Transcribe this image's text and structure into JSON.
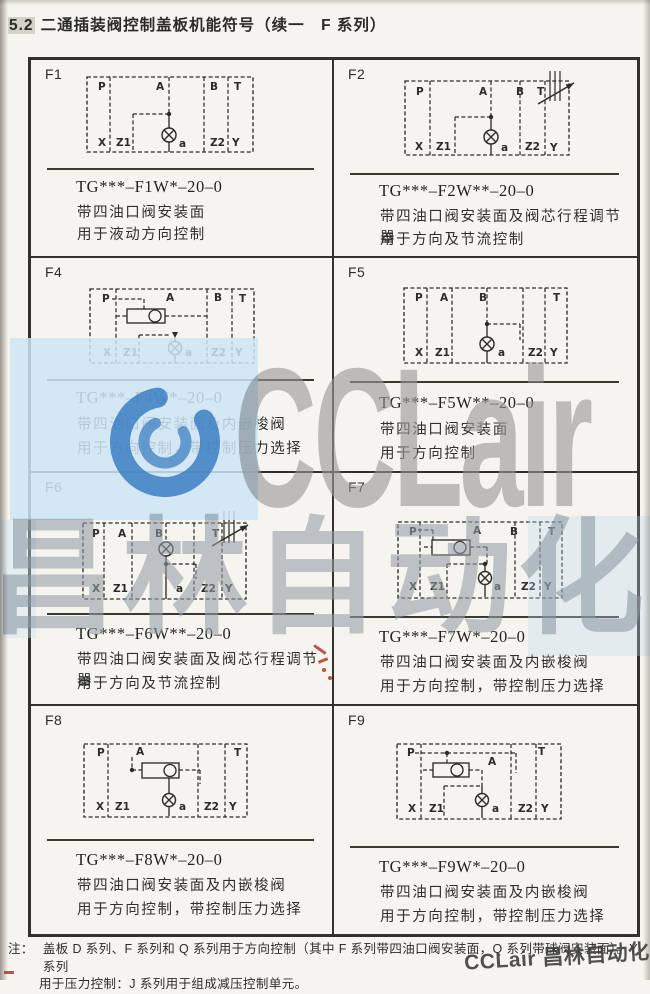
{
  "header": {
    "num": "5.2",
    "title": "二通插装阀控制盖板机能符号（续一　F 系列）"
  },
  "watermark": {
    "brand": "CCLair",
    "brand_cn": "昌林自动化",
    "corner": "CCLair 昌林自动化",
    "accent_blue": "#3e86c8",
    "band_blue": "#cde4f5",
    "gray": "#989895"
  },
  "footnote": {
    "label": "注：",
    "line1": "盖板 D 系列、F 系列和 Q 系列用于方向控制（其中 F 系列带四油口阀安装面，Q 系列带球阀安装面）。Y 系列",
    "line2": "用于压力控制：J 系列用于组成减压控制单元。"
  },
  "cells": [
    {
      "code": "F1",
      "model": "TG***–F1W*–20–0",
      "desc1": "带四油口阀安装面",
      "desc2": "用于液动方向控制",
      "diagram": {
        "vb": [
          170,
          78
        ],
        "rect": [
          1,
          1,
          166,
          75
        ],
        "dividers": [
          24,
          118,
          142
        ],
        "labels": [
          {
            "t": "P",
            "x": 12,
            "y": 14
          },
          {
            "t": "A",
            "x": 70,
            "y": 14
          },
          {
            "t": "B",
            "x": 124,
            "y": 14
          },
          {
            "t": "T",
            "x": 148,
            "y": 14
          },
          {
            "t": "X",
            "x": 12,
            "y": 70
          },
          {
            "t": "Z1",
            "x": 30,
            "y": 70
          },
          {
            "t": "a",
            "x": 93,
            "y": 71
          },
          {
            "t": "Z2",
            "x": 124,
            "y": 70
          },
          {
            "t": "Y",
            "x": 146,
            "y": 70
          }
        ],
        "dashed": [
          [
            83,
            1,
            83,
            38
          ],
          [
            47,
            38,
            83,
            38
          ],
          [
            47,
            38,
            47,
            76
          ]
        ],
        "solid": [
          [
            83,
            38,
            83,
            52
          ],
          [
            83,
            66,
            83,
            76
          ]
        ],
        "dots": [
          [
            83,
            38
          ]
        ],
        "valve": {
          "x": 83,
          "y": 59,
          "r": 7
        }
      }
    },
    {
      "code": "F2",
      "model": "TG***–F2W**–20–0",
      "desc1": "带四油口阀安装面及阀芯行程调节器",
      "desc2": "用于方向及节流控制",
      "diagram": {
        "vb": [
          178,
          88
        ],
        "rect": [
          1,
          10,
          164,
          74
        ],
        "dividers": [
          26,
          116,
          141
        ],
        "labels": [
          {
            "t": "P",
            "x": 12,
            "y": 24
          },
          {
            "t": "A",
            "x": 75,
            "y": 24
          },
          {
            "t": "B",
            "x": 112,
            "y": 24
          },
          {
            "t": "T",
            "x": 133,
            "y": 24
          },
          {
            "t": "X",
            "x": 11,
            "y": 79
          },
          {
            "t": "Z1",
            "x": 32,
            "y": 79
          },
          {
            "t": "a",
            "x": 97,
            "y": 80
          },
          {
            "t": "Z2",
            "x": 121,
            "y": 79
          },
          {
            "t": "Y",
            "x": 146,
            "y": 80
          }
        ],
        "dashed": [
          [
            87,
            10,
            87,
            46
          ],
          [
            51,
            46,
            87,
            46
          ],
          [
            51,
            46,
            51,
            84
          ]
        ],
        "solid": [
          [
            87,
            46,
            87,
            59
          ],
          [
            87,
            73,
            87,
            84
          ]
        ],
        "dots": [
          [
            87,
            46
          ]
        ],
        "valve": {
          "x": 87,
          "y": 66,
          "r": 7
        },
        "adjuster": {
          "x": 146,
          "y": 0,
          "h": 30,
          "ax1": 134,
          "ay1": 33,
          "ax2": 170,
          "ay2": 12
        }
      }
    },
    {
      "code": "F4",
      "model": "TG***–F4W*–20–0",
      "desc1": "带四油口阀安装面及内嵌梭阀",
      "desc2": "用于方向控制，带控制压力选择",
      "diagram": {
        "vb": [
          170,
          80
        ],
        "rect": [
          1,
          1,
          164,
          74
        ],
        "dividers": [
          27,
          118,
          143
        ],
        "labels": [
          {
            "t": "P",
            "x": 13,
            "y": 14
          },
          {
            "t": "A",
            "x": 77,
            "y": 13
          },
          {
            "t": "B",
            "x": 125,
            "y": 13
          },
          {
            "t": "T",
            "x": 150,
            "y": 14
          },
          {
            "t": "X",
            "x": 14,
            "y": 68
          },
          {
            "t": "Z1",
            "x": 34,
            "y": 68
          },
          {
            "t": "a",
            "x": 96,
            "y": 68
          },
          {
            "t": "Z2",
            "x": 122,
            "y": 68
          },
          {
            "t": "Y",
            "x": 146,
            "y": 68
          }
        ],
        "dashed": [
          [
            23,
            11,
            55,
            11
          ],
          [
            55,
            11,
            55,
            21
          ],
          [
            27,
            28,
            38,
            28
          ],
          [
            76,
            28,
            118,
            28
          ],
          [
            50,
            47,
            82,
            47
          ],
          [
            50,
            47,
            50,
            75
          ]
        ],
        "solid": [
          [
            86,
            50,
            86,
            53
          ],
          [
            86,
            67,
            86,
            75
          ]
        ],
        "dots": [],
        "arrows": [
          [
            86,
            50
          ]
        ],
        "valve": {
          "x": 86,
          "y": 60,
          "r": 6.5
        },
        "shuttle": {
          "x": 38,
          "y": 21,
          "w": 38,
          "h": 14,
          "bx": 66,
          "by": 28,
          "br": 6
        }
      }
    },
    {
      "code": "F5",
      "model": "TG***–F5W**–20–0",
      "desc1": "带四油口阀安装面",
      "desc2": "用于方向控制",
      "diagram": {
        "vb": [
          170,
          78
        ],
        "rect": [
          1,
          1,
          163,
          75
        ],
        "dividers": [
          24,
          49,
          120,
          142
        ],
        "labels": [
          {
            "t": "P",
            "x": 12,
            "y": 14
          },
          {
            "t": "A",
            "x": 37,
            "y": 14
          },
          {
            "t": "B",
            "x": 76,
            "y": 14
          },
          {
            "t": "T",
            "x": 150,
            "y": 14
          },
          {
            "t": "X",
            "x": 12,
            "y": 69
          },
          {
            "t": "Z1",
            "x": 32,
            "y": 69
          },
          {
            "t": "a",
            "x": 95,
            "y": 69
          },
          {
            "t": "Z2",
            "x": 125,
            "y": 69
          },
          {
            "t": "Y",
            "x": 147,
            "y": 69
          }
        ],
        "dashed": [
          [
            84,
            1,
            84,
            37
          ],
          [
            84,
            37,
            117,
            37
          ],
          [
            117,
            37,
            117,
            53
          ]
        ],
        "solid": [
          [
            84,
            37,
            84,
            50
          ],
          [
            84,
            64,
            84,
            76
          ]
        ],
        "dots": [
          [
            84,
            37
          ]
        ],
        "valve": {
          "x": 84,
          "y": 57,
          "r": 7
        }
      }
    },
    {
      "code": "F6",
      "model": "TG***–F6W**–20–0",
      "desc1": "带四油口阀安装面及阀芯行程调节器",
      "desc2": "用于方向及节流控制",
      "diagram": {
        "vb": [
          184,
          92
        ],
        "rect": [
          1,
          12,
          163,
          76
        ],
        "dividers": [
          22,
          50,
          112,
          140
        ],
        "labels": [
          {
            "t": "P",
            "x": 10,
            "y": 26
          },
          {
            "t": "A",
            "x": 36,
            "y": 26
          },
          {
            "t": "B",
            "x": 73,
            "y": 26
          },
          {
            "t": "T",
            "x": 130,
            "y": 26
          },
          {
            "t": "X",
            "x": 10,
            "y": 81
          },
          {
            "t": "Z1",
            "x": 31,
            "y": 81
          },
          {
            "t": "a",
            "x": 94,
            "y": 81
          },
          {
            "t": "Z2",
            "x": 119,
            "y": 81
          },
          {
            "t": "Y",
            "x": 143,
            "y": 81
          }
        ],
        "dashed": [
          [
            84,
            12,
            84,
            31
          ],
          [
            84,
            53,
            114,
            53
          ],
          [
            114,
            53,
            114,
            68
          ]
        ],
        "solid": [
          [
            84,
            45,
            84,
            53
          ],
          [
            84,
            53,
            84,
            88
          ]
        ],
        "dots": [
          [
            84,
            53
          ]
        ],
        "valve": {
          "x": 84,
          "y": 38,
          "r": 7
        },
        "adjuster": {
          "x": 142,
          "y": 0,
          "h": 32,
          "ax1": 130,
          "ay1": 35,
          "ax2": 166,
          "ay2": 14
        }
      }
    },
    {
      "code": "F7",
      "model": "TG***–F7W*–20–0",
      "desc1": "带四油口阀安装面及内嵌梭阀",
      "desc2": "用于方向控制，带控制压力选择",
      "diagram": {
        "vb": [
          170,
          80
        ],
        "rect": [
          1,
          1,
          164,
          76
        ],
        "dividers": [
          23,
          118,
          143
        ],
        "labels": [
          {
            "t": "P",
            "x": 12,
            "y": 14
          },
          {
            "t": "A",
            "x": 76,
            "y": 13
          },
          {
            "t": "B",
            "x": 113,
            "y": 14
          },
          {
            "t": "T",
            "x": 151,
            "y": 14
          },
          {
            "t": "X",
            "x": 12,
            "y": 69
          },
          {
            "t": "Z1",
            "x": 33,
            "y": 69
          },
          {
            "t": "a",
            "x": 97,
            "y": 69
          },
          {
            "t": "Z2",
            "x": 124,
            "y": 69
          },
          {
            "t": "Y",
            "x": 147,
            "y": 69
          }
        ],
        "dashed": [
          [
            21,
            9,
            36,
            9
          ],
          [
            36,
            9,
            36,
            19
          ],
          [
            27,
            26,
            35,
            26
          ],
          [
            73,
            26,
            90,
            26
          ],
          [
            90,
            26,
            90,
            43
          ],
          [
            50,
            43,
            86,
            43
          ],
          [
            50,
            43,
            50,
            76
          ]
        ],
        "solid": [
          [
            88,
            43,
            88,
            51
          ],
          [
            88,
            64,
            88,
            76
          ]
        ],
        "dots": [
          [
            88,
            43
          ]
        ],
        "valve": {
          "x": 88,
          "y": 57,
          "r": 6.5
        },
        "shuttle": {
          "x": 35,
          "y": 19,
          "w": 38,
          "h": 15,
          "bx": 63,
          "by": 26.5,
          "br": 6
        }
      }
    },
    {
      "code": "F8",
      "model": "TG***–F8W*–20–0",
      "desc1": "带四油口阀安装面及内嵌梭阀",
      "desc2": "用于方向控制，带控制压力选择",
      "diagram": {
        "vb": [
          170,
          78
        ],
        "rect": [
          1,
          1,
          163,
          73
        ],
        "dividers": [
          25,
          115,
          142
        ],
        "labels": [
          {
            "t": "P",
            "x": 14,
            "y": 13
          },
          {
            "t": "A",
            "x": 53,
            "y": 12
          },
          {
            "t": "T",
            "x": 151,
            "y": 13
          },
          {
            "t": "X",
            "x": 13,
            "y": 67
          },
          {
            "t": "Z1",
            "x": 32,
            "y": 67
          },
          {
            "t": "a",
            "x": 96,
            "y": 67
          },
          {
            "t": "Z2",
            "x": 121,
            "y": 67
          },
          {
            "t": "Y",
            "x": 146,
            "y": 67
          }
        ],
        "dashed": [
          [
            49,
            14,
            49,
            27
          ],
          [
            49,
            27,
            59,
            27
          ],
          [
            96,
            27,
            117,
            27
          ],
          [
            117,
            27,
            117,
            41
          ]
        ],
        "solid": [
          [
            86,
            35,
            86,
            50
          ],
          [
            86,
            64,
            86,
            73
          ]
        ],
        "dots": [
          [
            49,
            27
          ]
        ],
        "valve": {
          "x": 86,
          "y": 57,
          "r": 6.5
        },
        "shuttle": {
          "x": 59,
          "y": 20,
          "w": 37,
          "h": 15,
          "bx": 87,
          "by": 27.5,
          "br": 6
        }
      }
    },
    {
      "code": "F9",
      "model": "TG***–F9W*–20–0",
      "desc1": "带四油口阀安装面及内嵌梭阀",
      "desc2": "用于方向控制，带控制压力选择",
      "diagram": {
        "vb": [
          170,
          80
        ],
        "rect": [
          1,
          1,
          164,
          75
        ],
        "dividers": [
          25,
          115,
          140
        ],
        "labels": [
          {
            "t": "P",
            "x": 11,
            "y": 13
          },
          {
            "t": "A",
            "x": 92,
            "y": 22
          },
          {
            "t": "T",
            "x": 142,
            "y": 12
          },
          {
            "t": "X",
            "x": 12,
            "y": 69
          },
          {
            "t": "Z1",
            "x": 33,
            "y": 69
          },
          {
            "t": "a",
            "x": 96,
            "y": 69
          },
          {
            "t": "Z2",
            "x": 122,
            "y": 69
          },
          {
            "t": "Y",
            "x": 145,
            "y": 69
          }
        ],
        "dashed": [
          [
            19,
            10,
            120,
            10
          ],
          [
            120,
            10,
            120,
            30
          ],
          [
            51,
            10,
            51,
            20
          ],
          [
            27,
            27,
            37,
            27
          ],
          [
            73,
            27,
            86,
            27
          ],
          [
            86,
            27,
            86,
            43
          ],
          [
            48,
            43,
            86,
            43
          ],
          [
            48,
            43,
            48,
            75
          ]
        ],
        "solid": [
          [
            86,
            43,
            86,
            51
          ],
          [
            86,
            64,
            86,
            75
          ]
        ],
        "dots": [
          [
            51,
            10
          ]
        ],
        "valve": {
          "x": 86,
          "y": 57,
          "r": 6.5
        },
        "shuttle": {
          "x": 37,
          "y": 20,
          "w": 36,
          "h": 14,
          "bx": 61,
          "by": 27,
          "br": 6
        }
      }
    }
  ]
}
